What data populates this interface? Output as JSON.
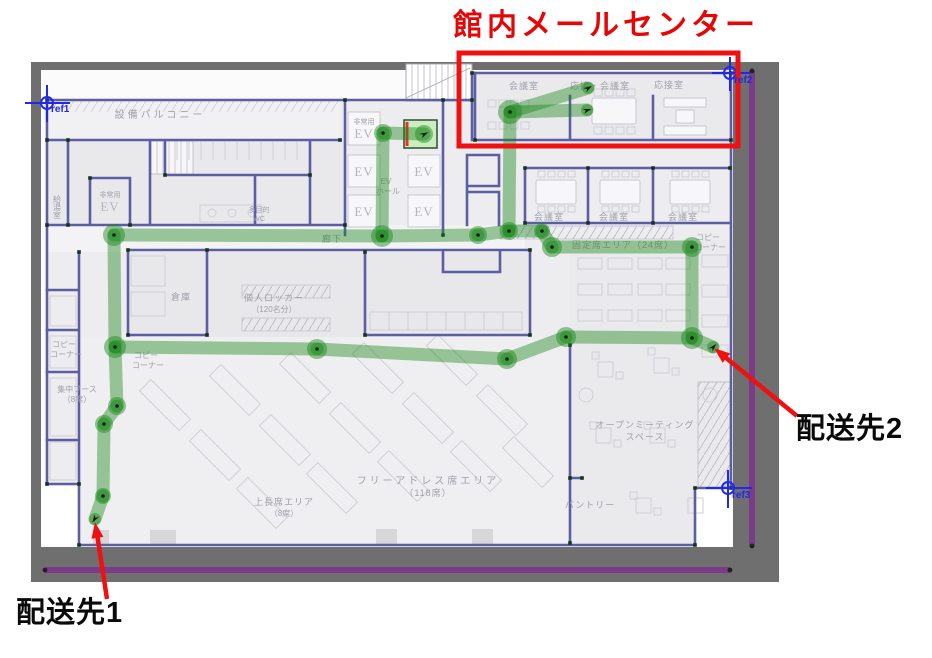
{
  "annotations": {
    "mail_center": {
      "title": "館内メールセンター"
    },
    "destinations": [
      {
        "label": "配送先1"
      },
      {
        "label": "配送先2"
      }
    ]
  },
  "reference_markers": [
    {
      "label": "ref1"
    },
    {
      "label": "ref2"
    },
    {
      "label": "ref3"
    }
  ],
  "floor_plan": {
    "rooms": {
      "equipment_balcony": "設備バルコニー",
      "emergency_elevator": {
        "line1": "非常用",
        "line2": "EV"
      },
      "elevator": "EV",
      "elevator_hall": {
        "line1": "EV",
        "line2": "ホール"
      },
      "corridor": "廊下",
      "kitchenette": "給湯室",
      "multipurpose_wc": {
        "line1": "多目的",
        "line2": "WC"
      },
      "storage": "倉庫",
      "personal_lockers": {
        "line1": "個人ロッカー",
        "line2": "（120名分）"
      },
      "copy_corner": {
        "line1": "コピー",
        "line2": "コーナー"
      },
      "focus_booth": {
        "line1": "集中ブース",
        "line2": "（8席）"
      },
      "meeting_room": "会議室",
      "reception_meeting_room": "応接・会議室",
      "reception_room": "応接室",
      "fixed_seat_area": "固定席エリア（24席）",
      "free_address_area": {
        "line1": "フリーアドレス席エリア",
        "line2": "（118席）"
      },
      "supervisor_area": {
        "line1": "上長席エリア",
        "line2": "（8席）"
      },
      "open_meeting_space": {
        "line1": "オープンミーティング",
        "line2": "スペース"
      },
      "pantry": "パントリー"
    }
  },
  "colors": {
    "route_green": "#178517",
    "start_highlight_green": "#c6ecba",
    "annotation_red": "#ee1111",
    "wall_blue": "#5d5da4",
    "reference_blue": "#2228e8",
    "boundary_purple": "#7c3b88",
    "frame_gray": "#6f6f6f"
  }
}
